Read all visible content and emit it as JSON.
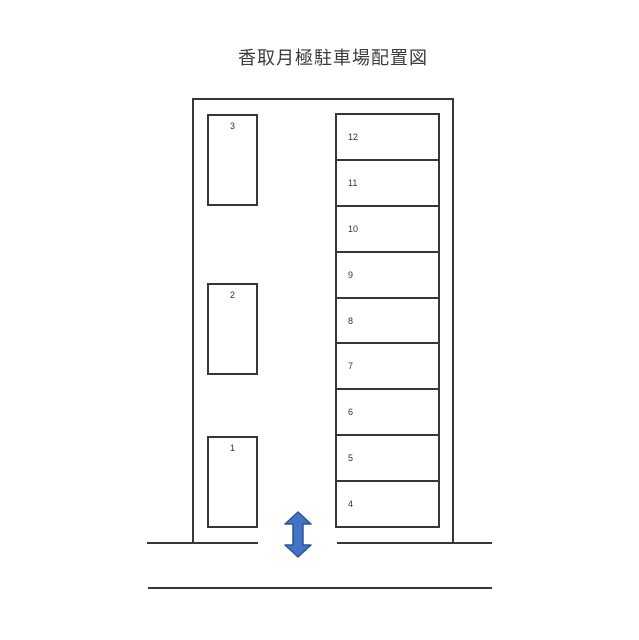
{
  "title": "香取月極駐車場配置図",
  "lot": {
    "left_spaces": [
      {
        "label": "3"
      },
      {
        "label": "2"
      },
      {
        "label": "1"
      }
    ],
    "right_spaces": [
      {
        "label": "12"
      },
      {
        "label": "11"
      },
      {
        "label": "10"
      },
      {
        "label": "9"
      },
      {
        "label": "8"
      },
      {
        "label": "7"
      },
      {
        "label": "6"
      },
      {
        "label": "5"
      },
      {
        "label": "4"
      }
    ]
  },
  "entrance": {
    "icon": "double-vertical-arrow-icon",
    "arrow_fill": "#4472C4",
    "arrow_stroke": "#2E5597"
  },
  "colors": {
    "background": "#ffffff",
    "line": "#373737",
    "text": "#3c3c3c"
  }
}
